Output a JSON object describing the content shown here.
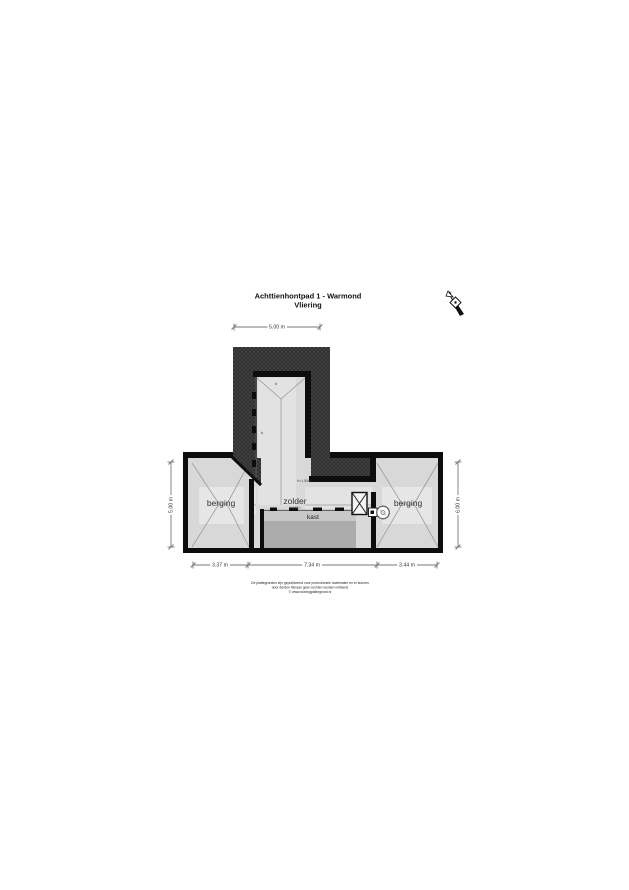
{
  "meta": {
    "title": "Achttienhontpad 1 - Warmond",
    "subtitle": "Vliering"
  },
  "compass": {
    "label": "N"
  },
  "rooms": {
    "berging_left": "berging",
    "zolder": "zolder",
    "zolder_sub": "h=1.50m",
    "kast": "kast",
    "berging_right": "berging",
    "height_note": "h=1.50m",
    "mark_top": "k",
    "mark_left": "k"
  },
  "dimensions": {
    "top": "5.00 m",
    "left": "5.00 m",
    "right": "6.00 m",
    "bottom": [
      "3.37 m",
      "7.34 m",
      "3.44 m"
    ]
  },
  "footer": {
    "line1": "De plattegronden zijn gepubliceerd voor promotionele doeleinden en er kunnen",
    "line2": "door derden hieraan geen rechten worden ontleend",
    "line3": "© www.woningplattegrond.nl"
  },
  "colors": {
    "roof_hatch": "#454545",
    "roof_hatch_line": "#2b2b2b",
    "wall": "#0d0d0d",
    "floor": "#d8d8d8",
    "floor_light": "#e6e6e6",
    "kast_fill": "#ababab",
    "kast_band": "#c8c8c8",
    "ridge_line": "#9c9c9c"
  }
}
